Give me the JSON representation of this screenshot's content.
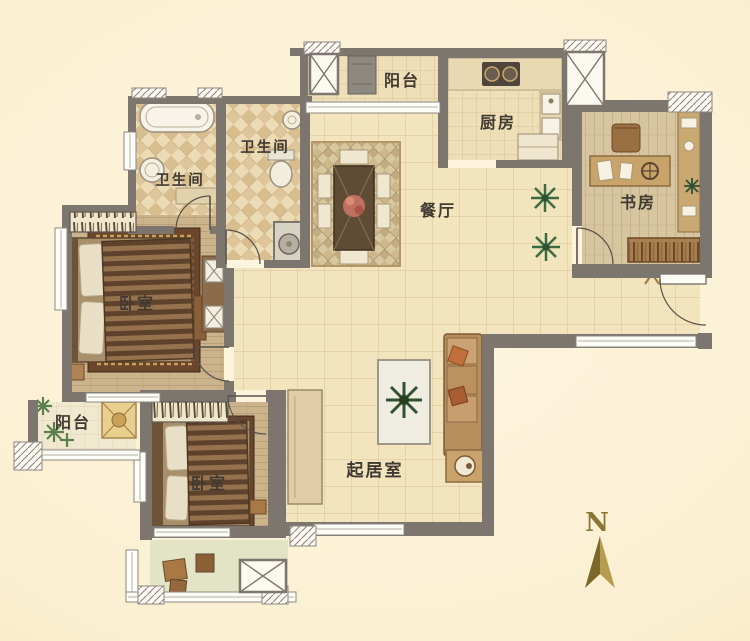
{
  "rooms": [
    {
      "id": "balcony-top",
      "label": "阳台"
    },
    {
      "id": "kitchen",
      "label": "厨房"
    },
    {
      "id": "bathroom-right",
      "label": "卫生间"
    },
    {
      "id": "bathroom-left",
      "label": "卫生间"
    },
    {
      "id": "dining-room",
      "label": "餐厅"
    },
    {
      "id": "study",
      "label": "书房"
    },
    {
      "id": "bedroom-master",
      "label": "卧室"
    },
    {
      "id": "balcony-left",
      "label": "阳台"
    },
    {
      "id": "bedroom-second",
      "label": "卧室"
    },
    {
      "id": "living-room",
      "label": "起居室"
    }
  ],
  "compass": {
    "label": "N"
  },
  "colors": {
    "wall": "#7c766f",
    "background": "#fbf0d3",
    "tile_floor": "#f2e4bd",
    "wood_floor": "#cbb48c",
    "bath_tile": "#ecdcb6",
    "rug_brown": "#6b452c",
    "sofa_tan": "#b98e5f",
    "plant_green": "#3c6b42",
    "compass_gold": "#8a7634"
  }
}
